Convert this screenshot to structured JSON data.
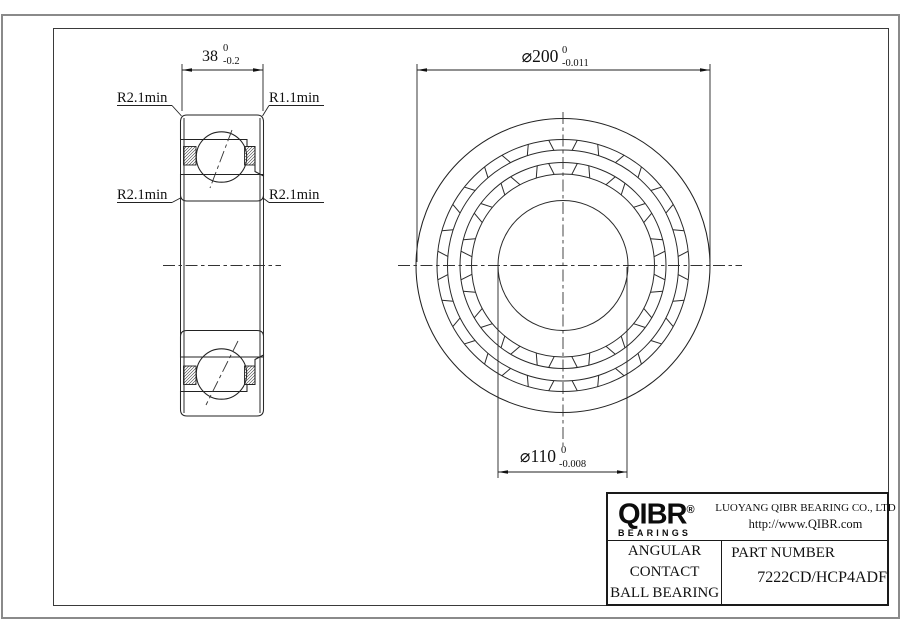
{
  "drawing": {
    "side_view": {
      "width_dim": {
        "label": "38",
        "tol_upper": "0",
        "tol_lower": "-0.2"
      },
      "labels": {
        "top_left": "R2.1min",
        "top_right": "R1.1min",
        "mid_left": "R2.1min",
        "mid_right": "R2.1min"
      }
    },
    "front_view": {
      "outer_dim": {
        "label": "⌀200",
        "tol_upper": "0",
        "tol_lower": "-0.011"
      },
      "bore_dim": {
        "label": "⌀110",
        "tol_upper": "0",
        "tol_lower": "-0.008"
      }
    }
  },
  "title_block": {
    "logo": {
      "brand": "QIBR",
      "registered": "®",
      "sub": "BEARINGS"
    },
    "company": "LUOYANG QIBR BEARING CO., LTD",
    "website": "http://www.QIBR.com",
    "product_line1": "ANGULAR CONTACT",
    "product_line2": "BALL BEARING",
    "part_number_label": "PART NUMBER",
    "part_number": "7222CD/HCP4ADF"
  },
  "colors": {
    "line": "#222222",
    "page_border": "#8a8a8a",
    "background": "#ffffff"
  }
}
